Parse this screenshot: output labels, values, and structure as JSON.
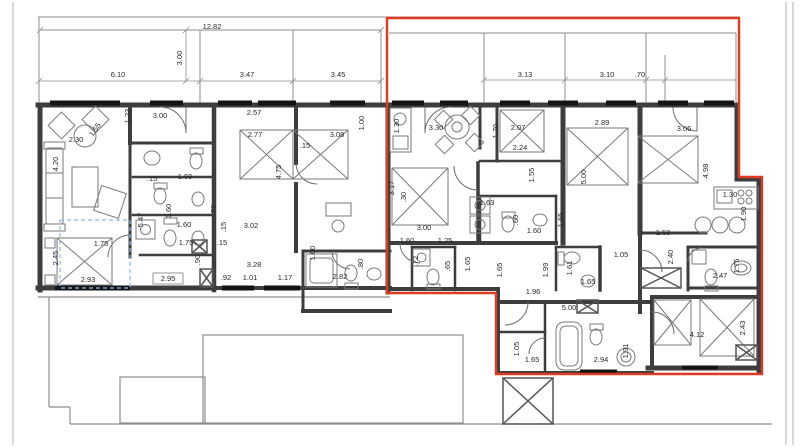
{
  "drawing": {
    "type": "architectural-floor-plan",
    "colors": {
      "highlight_outline": "#df3b20",
      "walls": "#3d3d3d",
      "thin_lines": "#8e8e8e",
      "dashed_accent": "#8fb7e8"
    }
  },
  "red_outline": {
    "points": "387,18 739,18 739,177 762,177 762,374 496,374 496,293 387,293"
  },
  "dims": [
    "12.82",
    "3.00",
    "6.10",
    "3.47",
    "3.45",
    "3.13",
    "3.10",
    ".70",
    "1.23",
    "3.00",
    "2.30",
    "1.55",
    "4.20",
    "5.47",
    ".15",
    "1.69",
    "1.60",
    "1.60",
    "1.75",
    "1.75",
    ".15",
    ".90",
    "2.45",
    "2.93",
    "2.95",
    ".92",
    "1.01",
    "3.28",
    "1.17",
    "2.82",
    "1.00",
    ".80",
    ".76",
    ".15",
    "3.02",
    "2.57",
    "2.77",
    "3.08",
    ".15",
    "1.00",
    "4.75",
    "1.30",
    "3.30",
    "3.17",
    "1.70",
    "2.07",
    "2.24",
    "1.55",
    "5.00",
    ".30",
    "1.63",
    ".60",
    "1.60",
    "1.65",
    "3.00",
    "1.60",
    "1.25",
    ".72",
    ".65",
    "1.65",
    "1.99",
    "1.61",
    "1.65",
    "1.96",
    "1.65",
    "2.89",
    "3.06",
    "4.98",
    "1.30",
    "1.90",
    "1.53",
    "1.05",
    "2.40",
    "1.75",
    "2.47",
    "2.43",
    "4.12",
    "2.94",
    "1.91",
    "5.00",
    "1.05",
    "1.65"
  ]
}
